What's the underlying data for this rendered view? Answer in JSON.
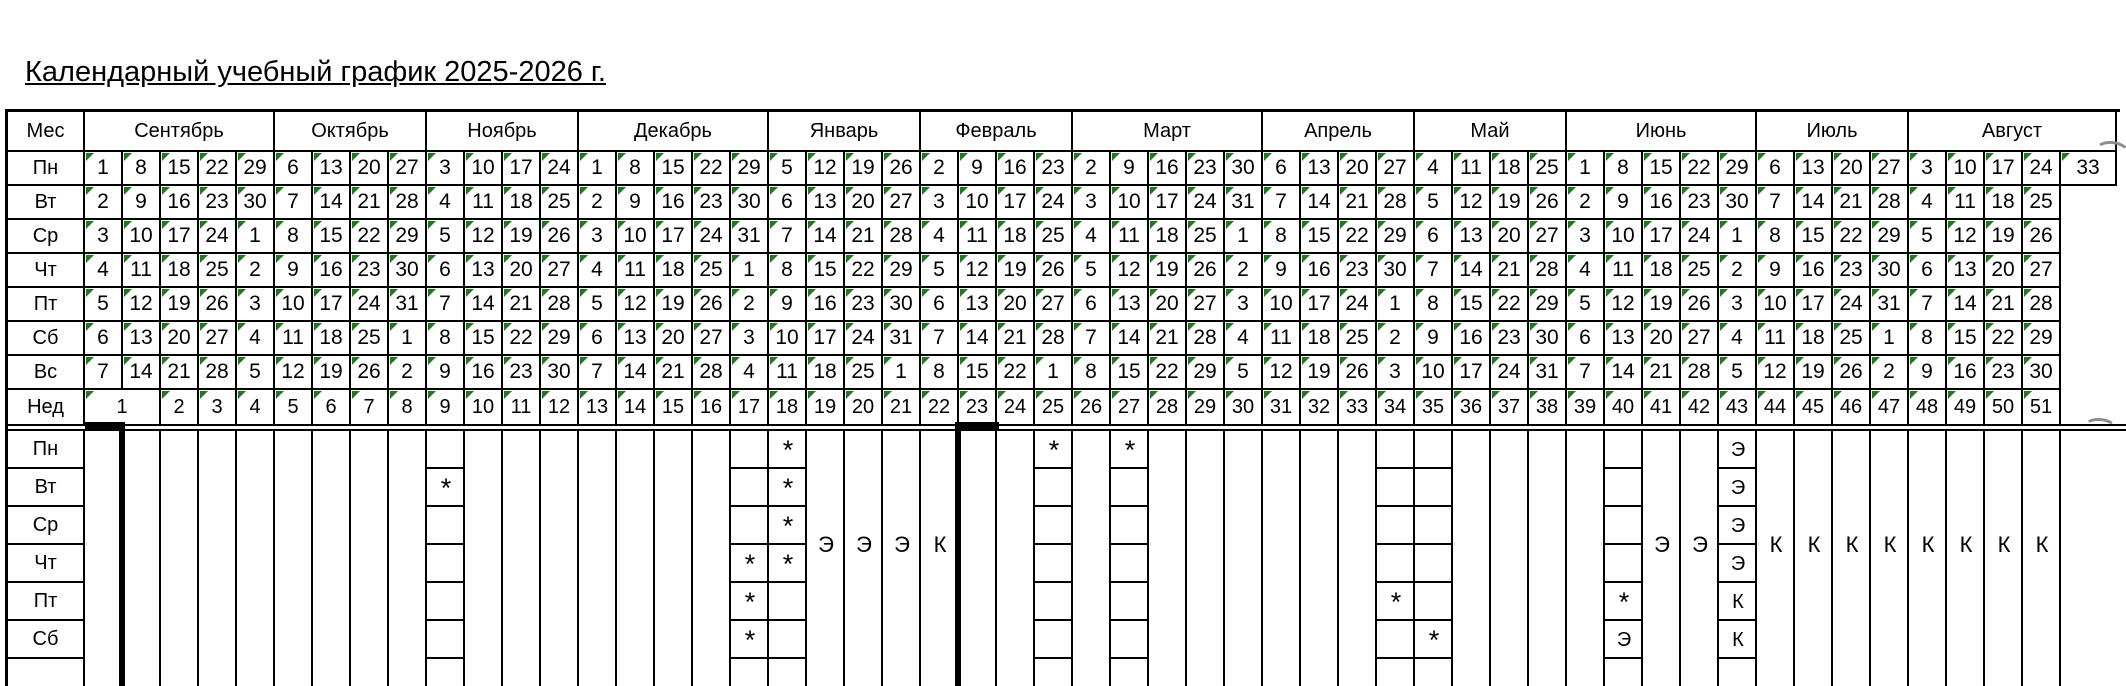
{
  "title": "Календарный учебный график 2025-2026 г.",
  "colors": {
    "marker_green": "#217821",
    "grid_black": "#000000",
    "artifact_gray": "#8e8e8e"
  },
  "table": {
    "corner_label": "Мес",
    "week_label": "Нед",
    "weekday_labels": [
      "Пн",
      "Вт",
      "Ср",
      "Чт",
      "Пт",
      "Сб",
      "Вс"
    ],
    "months": [
      {
        "name": "Сентябрь",
        "days": [
          [
            1,
            8,
            15,
            22,
            29
          ],
          [
            2,
            9,
            16,
            23,
            30
          ],
          [
            3,
            10,
            17,
            24,
            1
          ],
          [
            4,
            11,
            18,
            25,
            2
          ],
          [
            5,
            12,
            19,
            26,
            3
          ],
          [
            6,
            13,
            20,
            27,
            4
          ],
          [
            7,
            14,
            21,
            28,
            5
          ]
        ]
      },
      {
        "name": "Октябрь",
        "days": [
          [
            6,
            13,
            20,
            27
          ],
          [
            7,
            14,
            21,
            28
          ],
          [
            8,
            15,
            22,
            29
          ],
          [
            9,
            16,
            23,
            30
          ],
          [
            10,
            17,
            24,
            31
          ],
          [
            11,
            18,
            25,
            1
          ],
          [
            12,
            19,
            26,
            2
          ]
        ]
      },
      {
        "name": "Ноябрь",
        "days": [
          [
            3,
            10,
            17,
            24
          ],
          [
            4,
            11,
            18,
            25
          ],
          [
            5,
            12,
            19,
            26
          ],
          [
            6,
            13,
            20,
            27
          ],
          [
            7,
            14,
            21,
            28
          ],
          [
            8,
            15,
            22,
            29
          ],
          [
            9,
            16,
            23,
            30
          ]
        ]
      },
      {
        "name": "Декабрь",
        "days": [
          [
            1,
            8,
            15,
            22,
            29
          ],
          [
            2,
            9,
            16,
            23,
            30
          ],
          [
            3,
            10,
            17,
            24,
            31
          ],
          [
            4,
            11,
            18,
            25,
            1
          ],
          [
            5,
            12,
            19,
            26,
            2
          ],
          [
            6,
            13,
            20,
            27,
            3
          ],
          [
            7,
            14,
            21,
            28,
            4
          ]
        ]
      },
      {
        "name": "Январь",
        "days": [
          [
            5,
            12,
            19,
            26
          ],
          [
            6,
            13,
            20,
            27
          ],
          [
            7,
            14,
            21,
            28
          ],
          [
            8,
            15,
            22,
            29
          ],
          [
            9,
            16,
            23,
            30
          ],
          [
            10,
            17,
            24,
            31
          ],
          [
            11,
            18,
            25,
            1
          ]
        ]
      },
      {
        "name": "Февраль",
        "days": [
          [
            2,
            9,
            16,
            23
          ],
          [
            3,
            10,
            17,
            24
          ],
          [
            4,
            11,
            18,
            25
          ],
          [
            5,
            12,
            19,
            26
          ],
          [
            6,
            13,
            20,
            27
          ],
          [
            7,
            14,
            21,
            28
          ],
          [
            8,
            15,
            22,
            1
          ]
        ]
      },
      {
        "name": "Март",
        "days": [
          [
            2,
            9,
            16,
            23,
            30
          ],
          [
            3,
            10,
            17,
            24,
            31
          ],
          [
            4,
            11,
            18,
            25,
            1
          ],
          [
            5,
            12,
            19,
            26,
            2
          ],
          [
            6,
            13,
            20,
            27,
            3
          ],
          [
            7,
            14,
            21,
            28,
            4
          ],
          [
            8,
            15,
            22,
            29,
            5
          ]
        ]
      },
      {
        "name": "Апрель",
        "days": [
          [
            6,
            13,
            20,
            27
          ],
          [
            7,
            14,
            21,
            28
          ],
          [
            8,
            15,
            22,
            29
          ],
          [
            9,
            16,
            23,
            30
          ],
          [
            10,
            17,
            24,
            1
          ],
          [
            11,
            18,
            25,
            2
          ],
          [
            12,
            19,
            26,
            3
          ]
        ]
      },
      {
        "name": "Май",
        "days": [
          [
            4,
            11,
            18,
            25
          ],
          [
            5,
            12,
            19,
            26
          ],
          [
            6,
            13,
            20,
            27
          ],
          [
            7,
            14,
            21,
            28
          ],
          [
            8,
            15,
            22,
            29
          ],
          [
            9,
            16,
            23,
            30
          ],
          [
            10,
            17,
            24,
            31
          ]
        ]
      },
      {
        "name": "Июнь",
        "days": [
          [
            1,
            8,
            15,
            22,
            29
          ],
          [
            2,
            9,
            16,
            23,
            30
          ],
          [
            3,
            10,
            17,
            24,
            1
          ],
          [
            4,
            11,
            18,
            25,
            2
          ],
          [
            5,
            12,
            19,
            26,
            3
          ],
          [
            6,
            13,
            20,
            27,
            4
          ],
          [
            7,
            14,
            21,
            28,
            5
          ]
        ]
      },
      {
        "name": "Июль",
        "days": [
          [
            6,
            13,
            20,
            27
          ],
          [
            7,
            14,
            21,
            28
          ],
          [
            8,
            15,
            22,
            29
          ],
          [
            9,
            16,
            23,
            30
          ],
          [
            10,
            17,
            24,
            31
          ],
          [
            11,
            18,
            25,
            1
          ],
          [
            12,
            19,
            26,
            2
          ]
        ]
      },
      {
        "name": "Август",
        "days": [
          [
            3,
            10,
            17,
            24,
            33
          ],
          [
            4,
            11,
            18,
            25
          ],
          [
            5,
            12,
            19,
            26
          ],
          [
            6,
            13,
            20,
            27
          ],
          [
            7,
            14,
            21,
            28
          ],
          [
            8,
            15,
            22,
            29
          ],
          [
            9,
            16,
            23,
            30
          ]
        ]
      }
    ],
    "week_row": {
      "merged_first": "1",
      "numbers": [
        2,
        3,
        4,
        5,
        6,
        7,
        8,
        9,
        10,
        11,
        12,
        13,
        14,
        15,
        16,
        17,
        18,
        19,
        20,
        21,
        22,
        23,
        24,
        25,
        26,
        27,
        28,
        29,
        30,
        31,
        32,
        33,
        34,
        35,
        36,
        37,
        38,
        39,
        40,
        41,
        42,
        43,
        44,
        45,
        46,
        47,
        48,
        49,
        50,
        51
      ]
    }
  },
  "lower_section": {
    "row_labels": [
      "Пн",
      "Вт",
      "Ср",
      "Чт",
      "Пт",
      "Сб"
    ],
    "boxed_columns": [
      {
        "col": 10,
        "cells": {
          "Вт": "*"
        }
      },
      {
        "col": 18,
        "cells": {
          "Чт": "*",
          "Пт": "*",
          "Сб": "*"
        }
      },
      {
        "col": 19,
        "cells": {
          "Пн": "*",
          "Вт": "*",
          "Ср": "*",
          "Чт": "*"
        }
      },
      {
        "col": 26,
        "cells": {
          "Пн": "*"
        }
      },
      {
        "col": 28,
        "cells": {
          "Пн": "*"
        }
      },
      {
        "col": 35,
        "cells": {
          "Пт": "*"
        }
      },
      {
        "col": 36,
        "cells": {
          "Сб": "*"
        }
      },
      {
        "col": 41,
        "cells": {
          "Пт": "*",
          "Сб": "Э"
        }
      },
      {
        "col": 44,
        "cells": {
          "Пн": "Э",
          "Вт": "Э",
          "Ср": "Э",
          "Чт": "Э",
          "Пт": "К",
          "Сб": "К"
        }
      }
    ],
    "merged_letters": [
      {
        "col": 20,
        "letter": "Э"
      },
      {
        "col": 21,
        "letter": "Э"
      },
      {
        "col": 22,
        "letter": "Э"
      },
      {
        "col": 23,
        "letter": "К"
      },
      {
        "col": 42,
        "letter": "Э"
      },
      {
        "col": 43,
        "letter": "Э"
      },
      {
        "col": 45,
        "letter": "К"
      },
      {
        "col": 46,
        "letter": "К"
      },
      {
        "col": 47,
        "letter": "К"
      },
      {
        "col": 48,
        "letter": "К"
      },
      {
        "col": 49,
        "letter": "К"
      },
      {
        "col": 50,
        "letter": "К"
      },
      {
        "col": 51,
        "letter": "К"
      },
      {
        "col": 52,
        "letter": "К"
      }
    ],
    "thick_marks": {
      "week_underline_cols": [
        1,
        24
      ],
      "vertical_boundary_left_of_cols": [
        2,
        24
      ]
    }
  }
}
